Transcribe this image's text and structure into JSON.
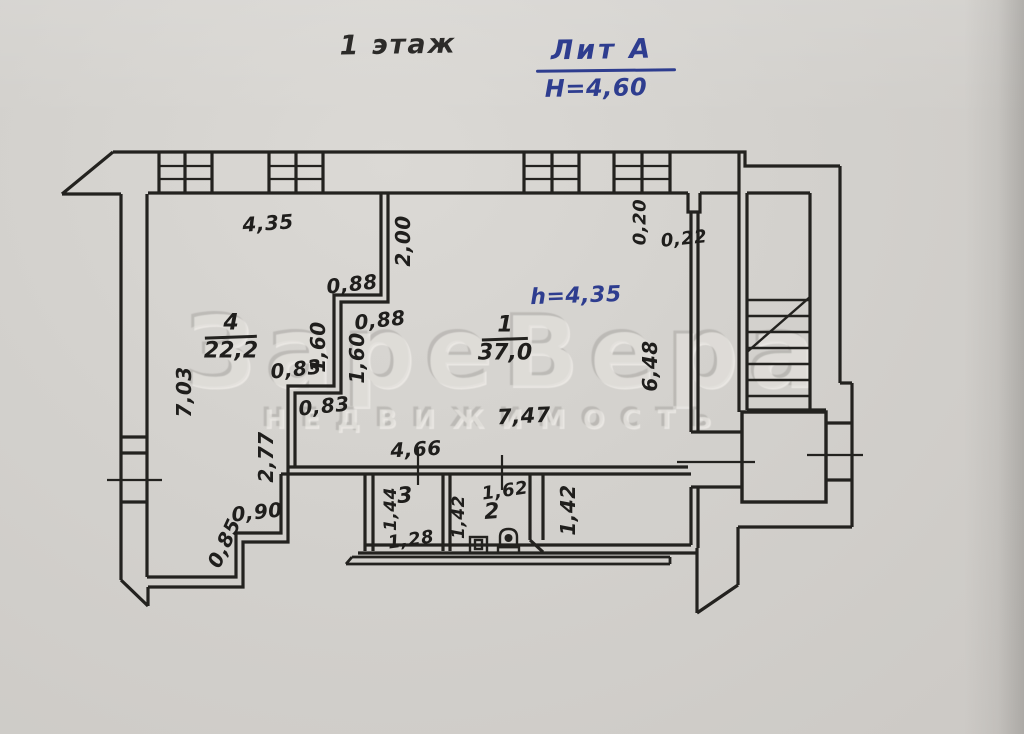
{
  "page": {
    "title": "1 этаж"
  },
  "header": {
    "lit_label": "Лит А",
    "building_height": "H=4,60"
  },
  "watermark": {
    "brand": "ЗареВера",
    "subtitle": "НЕДВИЖИМОСТЬ"
  },
  "rooms": {
    "room1": {
      "number": "1",
      "area": "37,0",
      "ceiling_height": "h=4,35"
    },
    "room2": {
      "number": "2"
    },
    "room3": {
      "number": "3"
    },
    "room4": {
      "number": "4",
      "area": "22,2"
    }
  },
  "dims": {
    "top_width": "4,35",
    "partition_top": "2,00",
    "notch_height": "0,20",
    "notch_width": "0,22",
    "step1_upper": "0,88",
    "step1_lower": "0,88",
    "mid_upper": "1,60",
    "mid_lower": "1,60",
    "step2_upper": "0,83",
    "step2_lower": "0,83",
    "left_height": "7,03",
    "left_lower": "2,77",
    "hall_width": "7,47",
    "right_height": "6,48",
    "step_width": "0,90",
    "chamfer": "0,85",
    "hall_bottom": "4,66",
    "room3_depth": "1,44",
    "room3_width": "1,28",
    "room2_depth": "1,42",
    "room2_width": "1,62",
    "corridor_right": "1,42"
  }
}
